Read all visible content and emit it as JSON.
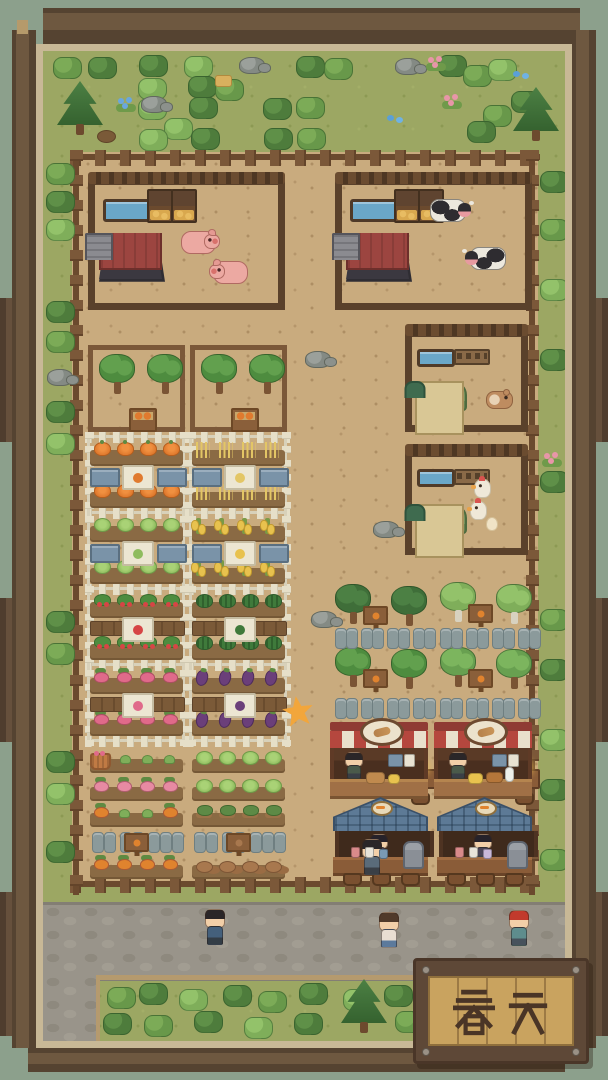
{
  "sign": {
    "text": "春天"
  },
  "palette": {
    "sage": "#8CA08C",
    "frame_dark": "#554331",
    "frame_mid": "#6E5840",
    "frame_tan": "#C8B896",
    "grass": "#9CA763",
    "dirt": "#C9AB7E",
    "fence": "#7B5839",
    "pen_fence": "#5A412B",
    "picket": "#E6DFC8",
    "barn_roof": "#46434B",
    "barn_wall": "#9C4540",
    "coop_roof": "#77945D",
    "coop_wall": "#D9C795",
    "water": "#6AA7C8",
    "hay": "#D9A84E",
    "pig_pink": "#ECA9A2",
    "cow_white": "#ECE8DE",
    "cow_spot": "#2E2C30",
    "chicken_white": "#EFE8D8",
    "path_stone": "#99948A",
    "path_edge": "#B59A6E",
    "awning_red": "#B5473E",
    "awning_cream": "#E9E0CC",
    "bar_roof": "#5D7A96",
    "counter_wood": "#A07046",
    "sign_wood": "#5E4837",
    "sign_text": "#4A3526",
    "star_gold": "#F2A63B"
  },
  "scene": {
    "zones": {
      "farm_dirt": [
        29,
        101,
        466,
        733
      ],
      "path_h": [
        0,
        851,
        522,
        73
      ],
      "path_v": [
        0,
        924,
        53,
        66
      ],
      "dirt_edge": [
        53,
        924,
        469,
        5
      ]
    },
    "farm_fences": [
      {
        "o": "h",
        "x": 27,
        "y": 99,
        "l": 470
      },
      {
        "o": "h",
        "x": 27,
        "y": 826,
        "l": 470
      },
      {
        "o": "v",
        "x": 27,
        "y": 99,
        "l": 745
      },
      {
        "o": "v",
        "x": 483,
        "y": 99,
        "l": 745
      }
    ],
    "decor": [
      [
        "bush",
        "m",
        10,
        6
      ],
      [
        "bush",
        "d",
        45,
        6
      ],
      [
        "bush",
        "d",
        96,
        4
      ],
      [
        "bush",
        "l",
        141,
        5
      ],
      [
        "bush",
        "d",
        253,
        5
      ],
      [
        "bush",
        "m",
        281,
        7
      ],
      [
        "bush",
        "d",
        395,
        4
      ],
      [
        "bush",
        "m",
        420,
        14
      ],
      [
        "bush",
        "l",
        445,
        8
      ],
      [
        "bush",
        "l",
        95,
        27
      ],
      [
        "bush",
        "d",
        145,
        25
      ],
      [
        "bush",
        "m",
        172,
        28
      ],
      [
        "bush",
        "l",
        95,
        47
      ],
      [
        "bush",
        "d",
        146,
        46
      ],
      [
        "bush",
        "d",
        220,
        47
      ],
      [
        "bush",
        "m",
        253,
        46
      ],
      [
        "bush",
        "d",
        468,
        40
      ],
      [
        "bush",
        "m",
        440,
        54
      ],
      [
        "bush",
        "l",
        121,
        67
      ],
      [
        "bush",
        "d",
        148,
        77
      ],
      [
        "bush",
        "d",
        221,
        77
      ],
      [
        "bush",
        "m",
        254,
        77
      ],
      [
        "bush",
        "l",
        96,
        78
      ],
      [
        "bush",
        "d",
        424,
        70
      ],
      [
        "pine",
        "",
        14,
        30
      ],
      [
        "pine",
        "",
        470,
        36
      ],
      [
        "rock",
        "",
        196,
        6
      ],
      [
        "rock",
        "",
        352,
        7
      ],
      [
        "rock",
        "",
        98,
        45
      ],
      [
        "flower",
        "#E896A8",
        383,
        6
      ],
      [
        "flower",
        "#E896A8",
        399,
        44
      ],
      [
        "flower",
        "#6AA7DD",
        73,
        47
      ],
      [
        "bfly",
        "",
        470,
        20
      ],
      [
        "bfly",
        "",
        344,
        64
      ],
      [
        "hay",
        "",
        172,
        24
      ],
      [
        "stump",
        "",
        54,
        79
      ],
      [
        "bush",
        "m",
        3,
        112
      ],
      [
        "bush",
        "d",
        3,
        140
      ],
      [
        "bush",
        "l",
        3,
        168
      ],
      [
        "bush",
        "d",
        3,
        250
      ],
      [
        "bush",
        "m",
        3,
        280
      ],
      [
        "rock",
        "",
        4,
        318
      ],
      [
        "bush",
        "d",
        3,
        350
      ],
      [
        "bush",
        "l",
        3,
        382
      ],
      [
        "bush",
        "d",
        3,
        560
      ],
      [
        "bush",
        "m",
        3,
        592
      ],
      [
        "bush",
        "d",
        3,
        700
      ],
      [
        "bush",
        "l",
        3,
        732
      ],
      [
        "bush",
        "d",
        3,
        790
      ],
      [
        "bush",
        "d",
        497,
        120
      ],
      [
        "bush",
        "m",
        497,
        168
      ],
      [
        "bush",
        "l",
        497,
        228
      ],
      [
        "bush",
        "d",
        497,
        298
      ],
      [
        "flower",
        "#E896A8",
        499,
        402
      ],
      [
        "bush",
        "d",
        497,
        420
      ],
      [
        "bush",
        "m",
        497,
        558
      ],
      [
        "bush",
        "d",
        497,
        608
      ],
      [
        "bush",
        "l",
        497,
        678
      ],
      [
        "bush",
        "d",
        497,
        728
      ],
      [
        "bush",
        "m",
        497,
        798
      ],
      [
        "rock",
        "",
        262,
        300
      ],
      [
        "rock",
        "",
        330,
        470
      ],
      [
        "rock",
        "",
        268,
        560
      ],
      [
        "bush",
        "m",
        64,
        936
      ],
      [
        "bush",
        "d",
        96,
        932
      ],
      [
        "bush",
        "l",
        136,
        938
      ],
      [
        "bush",
        "d",
        180,
        934
      ],
      [
        "bush",
        "m",
        215,
        940
      ],
      [
        "bush",
        "d",
        256,
        932
      ],
      [
        "bush",
        "l",
        300,
        938
      ],
      [
        "bush",
        "d",
        341,
        934
      ],
      [
        "bush",
        "d",
        60,
        962
      ],
      [
        "bush",
        "m",
        101,
        964
      ],
      [
        "bush",
        "d",
        151,
        960
      ],
      [
        "bush",
        "l",
        201,
        966
      ],
      [
        "bush",
        "d",
        251,
        962
      ],
      [
        "bush",
        "m",
        352,
        960
      ],
      [
        "pine",
        "",
        298,
        928
      ]
    ],
    "pens": [
      {
        "name": "pig-pen",
        "x": 45,
        "y": 127,
        "w": 197,
        "h": 132,
        "trough": [
          8,
          14,
          44,
          17
        ],
        "bins": [
          [
            52,
            4
          ],
          [
            76,
            4
          ]
        ],
        "bin_size": [
          22,
          30
        ],
        "bin_flat": false,
        "building": {
          "type": "barn",
          "x": 4,
          "y": 48,
          "w": 66,
          "h": 84
        },
        "animals": [
          {
            "t": "pig",
            "x": 86,
            "y": 46
          },
          {
            "t": "pig",
            "x": 118,
            "y": 76,
            "flip": true
          }
        ]
      },
      {
        "name": "cow-pen",
        "x": 292,
        "y": 127,
        "w": 197,
        "h": 132,
        "trough": [
          8,
          14,
          44,
          17
        ],
        "bins": [
          [
            52,
            4
          ],
          [
            76,
            4
          ]
        ],
        "bin_size": [
          22,
          30
        ],
        "bin_flat": false,
        "building": {
          "type": "barn",
          "x": 4,
          "y": 48,
          "w": 66,
          "h": 84
        },
        "animals": [
          {
            "t": "cow",
            "x": 88,
            "y": 14
          },
          {
            "t": "cow",
            "x": 128,
            "y": 62,
            "flip": true
          }
        ]
      },
      {
        "name": "hamster-pen",
        "x": 362,
        "y": 279,
        "w": 123,
        "h": 102,
        "trough": [
          5,
          12,
          32,
          12
        ],
        "bins": [
          [
            42,
            12
          ]
        ],
        "bin_size": [
          32,
          12
        ],
        "bin_flat": true,
        "building": {
          "type": "coop",
          "x": 3,
          "y": 44,
          "w": 52,
          "h": 54
        },
        "animals": [
          {
            "t": "hamster",
            "x": 74,
            "y": 54
          }
        ]
      },
      {
        "name": "chicken-pen",
        "x": 362,
        "y": 399,
        "w": 123,
        "h": 105,
        "trough": [
          5,
          12,
          32,
          12
        ],
        "bins": [
          [
            42,
            12
          ]
        ],
        "bin_size": [
          32,
          12
        ],
        "bin_flat": true,
        "building": {
          "type": "coop",
          "x": 3,
          "y": 47,
          "w": 52,
          "h": 54
        },
        "animals": [
          {
            "t": "chicken",
            "x": 62,
            "y": 22
          },
          {
            "t": "chicken",
            "x": 58,
            "y": 44
          },
          {
            "t": "egg",
            "x": 74,
            "y": 60
          }
        ]
      }
    ],
    "orchards": {
      "spec": {
        "w": 97,
        "h": 87,
        "trees": [
          [
            6,
            4
          ],
          [
            54,
            4
          ]
        ],
        "crate": [
          36,
          58,
          24,
          20
        ]
      },
      "plots": [
        {
          "x": 45,
          "y": 294
        },
        {
          "x": 147,
          "y": 294
        }
      ]
    },
    "garden": {
      "x": 45,
      "y": 381,
      "col_x": [
        0,
        102
      ],
      "col_w": 97,
      "row_y": [
        10,
        86,
        162,
        238
      ],
      "picket_y": [
        0,
        76,
        152,
        228,
        304
      ],
      "plots": [
        {
          "col": 0,
          "row": 0,
          "crop": "pumpkin",
          "mid": "blue",
          "c": "#E07A2E"
        },
        {
          "col": 1,
          "row": 0,
          "crop": "wheat",
          "mid": "blue",
          "c": "#E3C665"
        },
        {
          "col": 0,
          "row": 1,
          "crop": "cabbage",
          "mid": "blue",
          "c": "#8FBC5E"
        },
        {
          "col": 1,
          "row": 1,
          "crop": "corn",
          "mid": "blue",
          "c": "#E8C24E"
        },
        {
          "col": 0,
          "row": 2,
          "crop": "strawberry",
          "mid": "wood",
          "c": "#D64545"
        },
        {
          "col": 1,
          "row": 2,
          "crop": "watermelon",
          "mid": "wood",
          "c": "#3F7A3B"
        },
        {
          "col": 0,
          "row": 3,
          "crop": "radish",
          "mid": "wood",
          "c": "#E06A8A"
        },
        {
          "col": 1,
          "row": 3,
          "crop": "eggplant",
          "mid": "wood",
          "c": "#6B3F7A"
        }
      ]
    },
    "field": {
      "x": 45,
      "col_x": [
        0,
        102
      ],
      "col_w": 97,
      "row_y": [
        700,
        728,
        754,
        780,
        806
      ],
      "cells": [
        {
          "col": 0,
          "row": 0,
          "type": "sprouts",
          "basket": true
        },
        {
          "col": 1,
          "row": 0,
          "type": "cabbage"
        },
        {
          "col": 0,
          "row": 1,
          "type": "turnip_pink"
        },
        {
          "col": 1,
          "row": 1,
          "type": "cabbage"
        },
        {
          "col": 0,
          "row": 2,
          "type": "turnip_orange_mixed"
        },
        {
          "col": 1,
          "row": 2,
          "type": "potato_plant"
        },
        {
          "col": 0,
          "row": 3,
          "type": "beds",
          "sign_c": "#E0832E"
        },
        {
          "col": 1,
          "row": 3,
          "type": "beds",
          "sign_c": "#A8784E"
        },
        {
          "col": 0,
          "row": 4,
          "type": "carrot"
        },
        {
          "col": 1,
          "row": 4,
          "type": "potato_pile"
        }
      ]
    },
    "grove": {
      "clusters": [
        {
          "x": 292,
          "y": 533,
          "v": "oakdark"
        },
        {
          "x": 397,
          "y": 531,
          "v": "birch"
        },
        {
          "x": 292,
          "y": 596,
          "v": "oak"
        },
        {
          "x": 397,
          "y": 596,
          "v": "oaklight"
        }
      ],
      "slab_rows": [
        {
          "x": 292,
          "y": 577
        },
        {
          "x": 397,
          "y": 577
        },
        {
          "x": 292,
          "y": 647
        },
        {
          "x": 397,
          "y": 647
        }
      ],
      "slab_offsets": [
        0,
        11,
        26,
        37,
        52,
        63,
        78,
        89
      ]
    },
    "stalls": {
      "bakery": [
        {
          "x": 287,
          "y": 671,
          "food": [
            [
              36,
              50,
              17,
              10,
              "#C08A4E"
            ],
            [
              58,
              52,
              10,
              8,
              "#E8C24E"
            ]
          ]
        },
        {
          "x": 391,
          "y": 671,
          "food": [
            [
              34,
              51,
              13,
              9,
              "#E8C24E"
            ],
            [
              52,
              50,
              15,
              9,
              "#B5763A"
            ],
            [
              71,
              45,
              7,
              13,
              "#EEF0EA"
            ]
          ]
        }
      ],
      "tables": [
        {
          "x": 362,
          "y": 710
        },
        {
          "x": 466,
          "y": 710
        }
      ],
      "bars": [
        {
          "x": 290,
          "y": 746,
          "customer": true,
          "cups": [
            [
              18,
              50,
              7,
              9,
              "#D98A8A"
            ],
            [
              32,
              50,
              7,
              9,
              "#E8E4DA"
            ],
            [
              46,
              52,
              7,
              8,
              "#7A9AB5"
            ]
          ]
        },
        {
          "x": 394,
          "y": 746,
          "customer": false,
          "cups": [
            [
              18,
              50,
              7,
              9,
              "#D98A8A"
            ],
            [
              32,
              50,
              7,
              9,
              "#E8E4DA"
            ],
            [
              46,
              52,
              7,
              8,
              "#C9B8D8"
            ]
          ]
        }
      ],
      "stool_x": [
        10,
        39,
        68
      ]
    },
    "star": {
      "x": 239,
      "y": 645
    },
    "villagers": [
      {
        "x": 160,
        "y": 858,
        "hair": "#2A2628",
        "shirt": "#44607C",
        "pants": "#333D46"
      },
      {
        "x": 334,
        "y": 861,
        "hair": "#503A2A",
        "shirt": "#E9DED2",
        "pants": "#5C7A9C"
      },
      {
        "x": 464,
        "y": 859,
        "hair": "#C23A2C",
        "shirt": "#5E8D8D",
        "pants": "#47525C"
      }
    ],
    "counts": {
      "pigs": 2,
      "cows": 2,
      "hamsters": 1,
      "chickens": 2,
      "eggs": 1,
      "bakery_stalls": 2,
      "bar_stalls": 2,
      "villagers_on_path": 3
    }
  }
}
